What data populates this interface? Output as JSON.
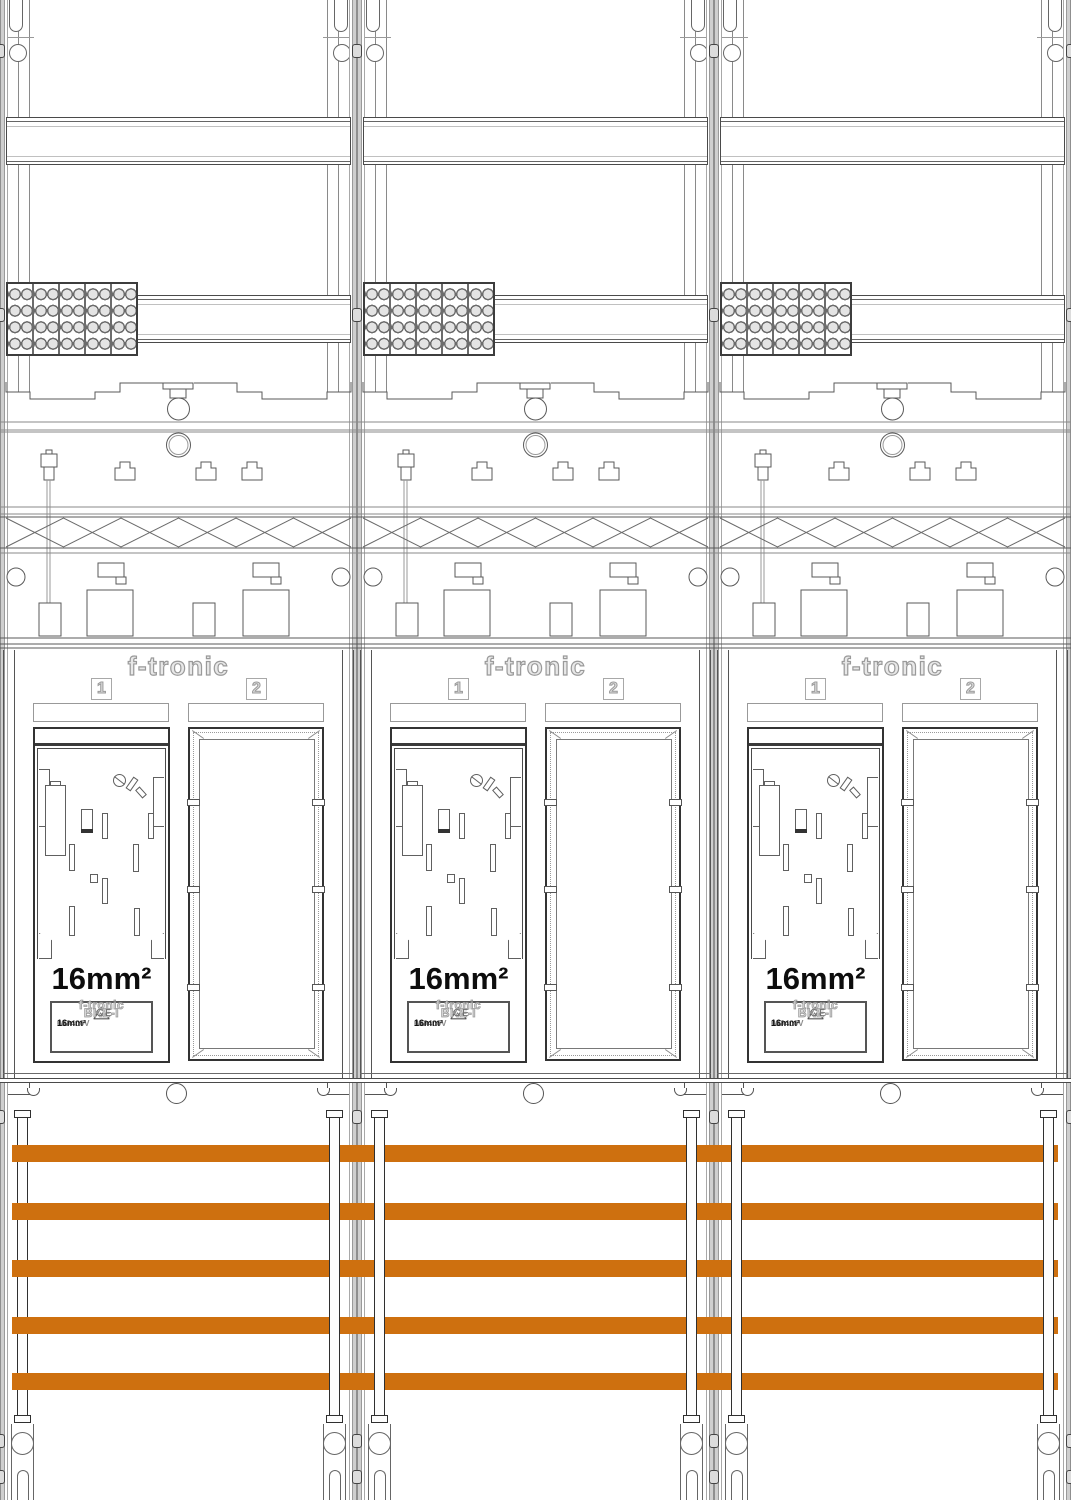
{
  "board": {
    "panels": [
      {
        "field1": "1",
        "field2": "2"
      },
      {
        "field1": "1",
        "field2": "2"
      },
      {
        "field1": "1",
        "field2": "2"
      }
    ]
  },
  "panel": {
    "brand": "f-tronic",
    "field1_label": "1",
    "field2_label": "2",
    "meter_size_label": "16mm²",
    "device_label": {
      "brand": "f-tronic",
      "model": "BKE-I",
      "ce_mark": "CE",
      "voltage": "AC 400V",
      "current": "63A",
      "cross_section": "16mm²"
    }
  },
  "terminal_block": {
    "segments": 5,
    "circle_rows": 4,
    "circle_cols": 2
  },
  "busbars": {
    "count": 5,
    "color": "#CE700F",
    "x": 12,
    "width": 1046,
    "height": 17,
    "y_positions": [
      1145,
      1203,
      1260,
      1317,
      1373
    ]
  },
  "colors": {
    "busbar": "#CE700F",
    "linework": "#4a4a4a",
    "outline_text": "#9a9a9a",
    "seam": "#bdbdbd"
  }
}
